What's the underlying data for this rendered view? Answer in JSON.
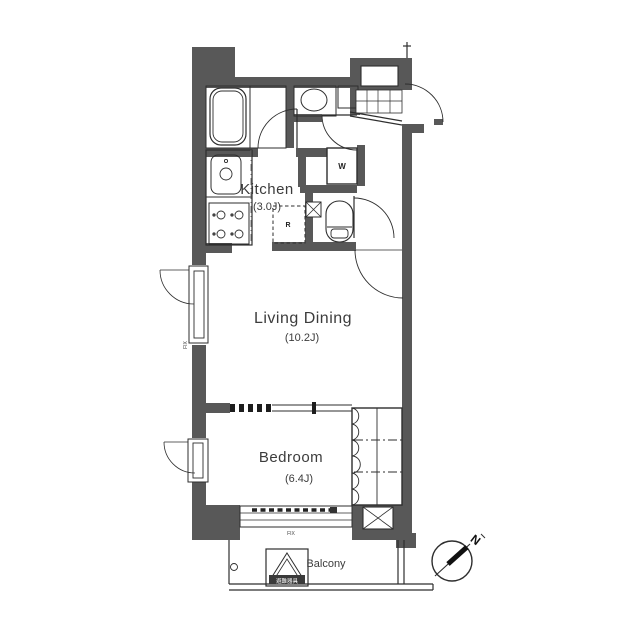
{
  "rooms": {
    "kitchen": {
      "name": "Kitchen",
      "size": "(3.0J)"
    },
    "living": {
      "name": "Living Dining",
      "size": "(10.2J)"
    },
    "bedroom": {
      "name": "Bedroom",
      "size": "(6.4J)"
    },
    "balcony": {
      "name": "Balcony"
    }
  },
  "appliances": {
    "washer": "W",
    "fridge": "R"
  },
  "windows": {
    "fix": "FIX"
  },
  "compass": {
    "north": "N"
  },
  "evacuation_hatch": {
    "label": "避難器具"
  },
  "colors": {
    "wall": "#585858",
    "line": "#2e2e2e",
    "background": "#ffffff"
  }
}
